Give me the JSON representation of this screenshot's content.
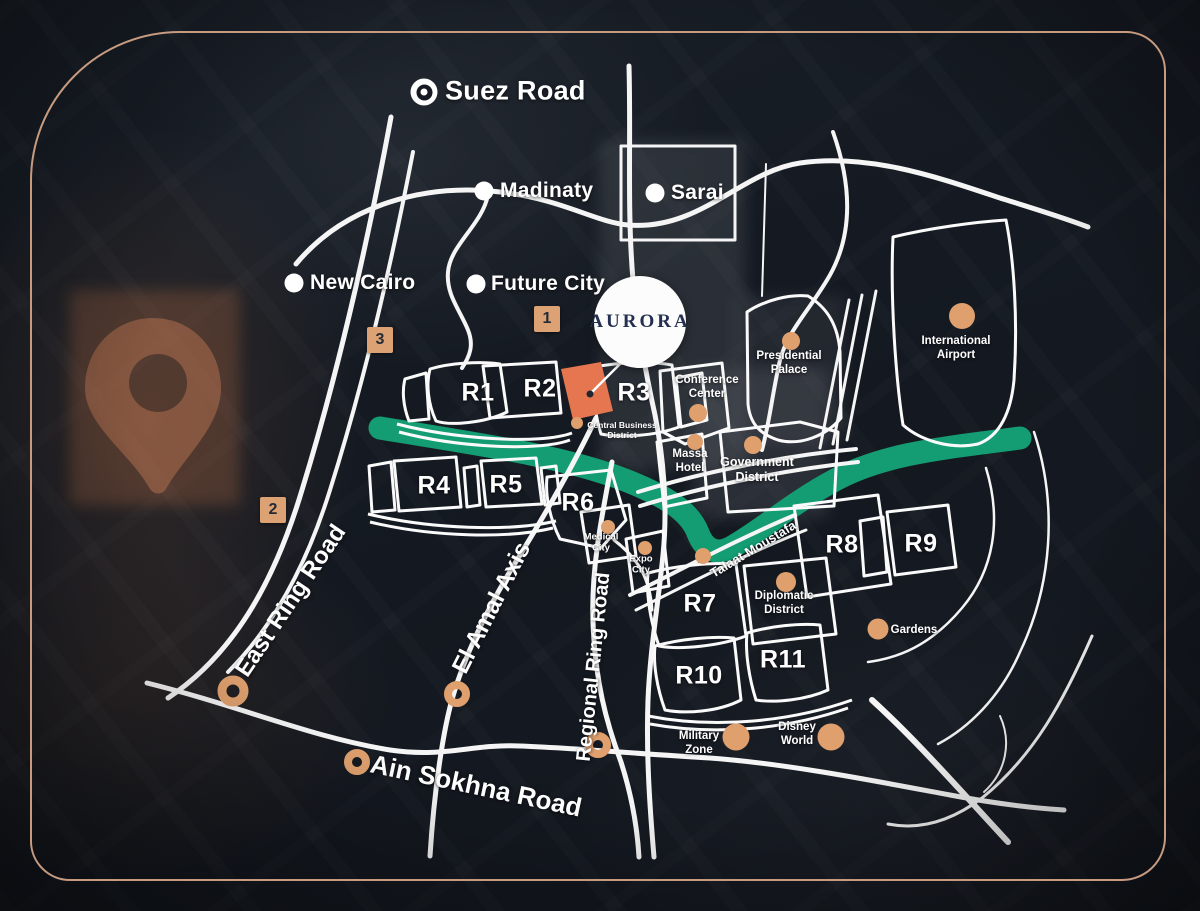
{
  "brand": {
    "name": "AURORA"
  },
  "badges": [
    {
      "label": "1"
    },
    {
      "label": "2"
    },
    {
      "label": "3"
    }
  ],
  "cities": [
    {
      "name": "Suez Road"
    },
    {
      "name": "Madinaty"
    },
    {
      "name": "Sarai"
    },
    {
      "name": "New Cairo"
    },
    {
      "name": "Future City"
    }
  ],
  "zones": [
    {
      "label": "R1"
    },
    {
      "label": "R2"
    },
    {
      "label": "R3"
    },
    {
      "label": "R4"
    },
    {
      "label": "R5"
    },
    {
      "label": "R6"
    },
    {
      "label": "R7"
    },
    {
      "label": "R8"
    },
    {
      "label": "R9"
    },
    {
      "label": "R10"
    },
    {
      "label": "R11"
    }
  ],
  "landmarks": [
    {
      "name": "Presidential\nPalace"
    },
    {
      "name": "International\nAirport"
    },
    {
      "name": "Conference\nCenter"
    },
    {
      "name": "Central Business\nDistrict"
    },
    {
      "name": "Massa\nHotel"
    },
    {
      "name": "Government\nDistrict"
    },
    {
      "name": "Medical\nCity"
    },
    {
      "name": "Expo\nCity"
    },
    {
      "name": "Diplomatic\nDistrict"
    },
    {
      "name": "Gardens"
    },
    {
      "name": "Military\nZone"
    },
    {
      "name": "Disney\nWorld"
    }
  ],
  "roads": [
    {
      "name": "East Ring Road"
    },
    {
      "name": "El Amal Axis"
    },
    {
      "name": "Regional Ring Road"
    },
    {
      "name": "Ain Sokhna Road"
    },
    {
      "name": "Talaat Moustafa"
    }
  ],
  "colors": {
    "accent_tan": "#dfa06e",
    "plot_orange": "#e5764f",
    "river_green": "#149c72",
    "frame_bronze": "#c79b80",
    "road_white": "#ffffff",
    "logo_navy": "#233050"
  },
  "icons": [
    {
      "name": "location-pin-icon"
    },
    {
      "name": "target-marker-icon"
    }
  ]
}
